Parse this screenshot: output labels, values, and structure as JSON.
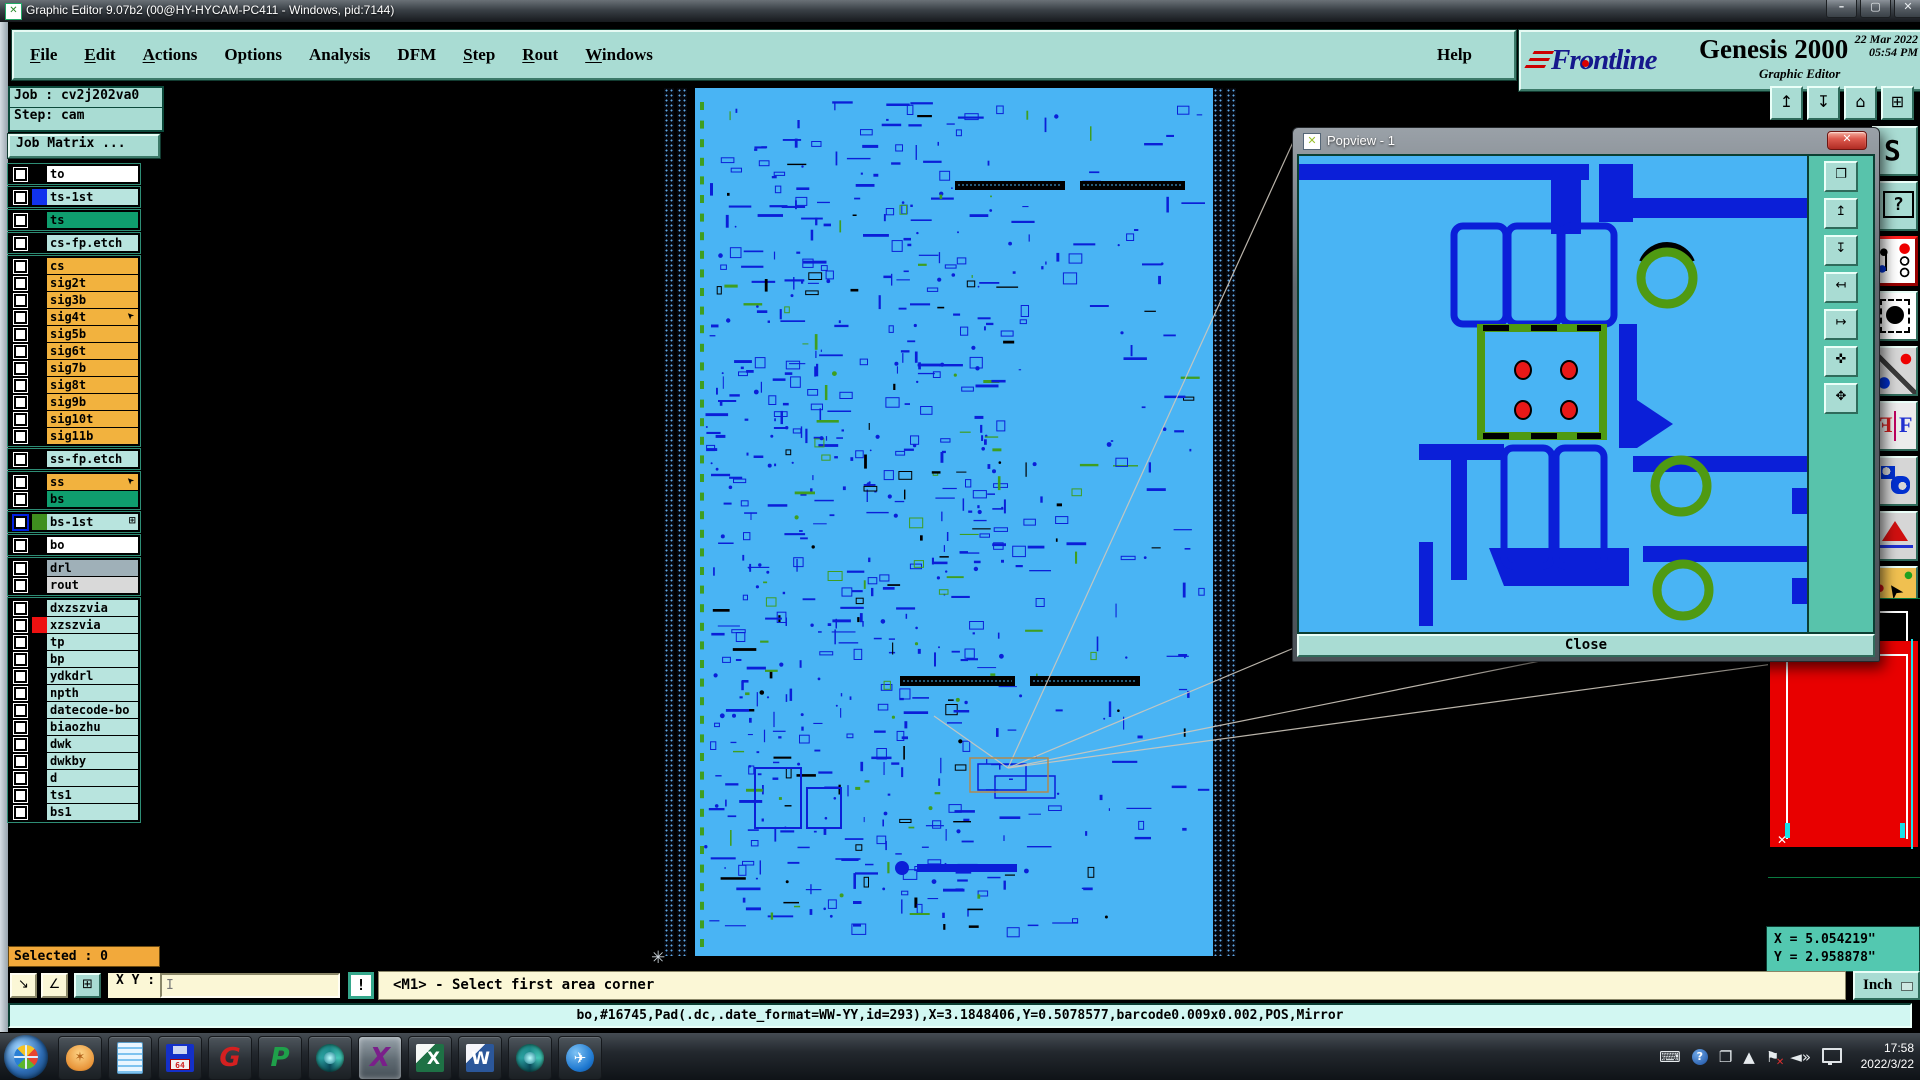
{
  "window": {
    "title": "Graphic Editor 9.07b2 (00@HY-HYCAM-PC411 - Windows, pid:7144)",
    "buttons": {
      "minimize": "–",
      "maximize": "▢",
      "close": "✕"
    }
  },
  "menu": {
    "items": [
      {
        "label": "File",
        "u": 0
      },
      {
        "label": "Edit",
        "u": 0
      },
      {
        "label": "Actions",
        "u": 0
      },
      {
        "label": "Options",
        "u": -1
      },
      {
        "label": "Analysis",
        "u": -1
      },
      {
        "label": "DFM",
        "u": -1
      },
      {
        "label": "Step",
        "u": 0
      },
      {
        "label": "Rout",
        "u": 0
      },
      {
        "label": "Windows",
        "u": 0
      }
    ],
    "help": "Help"
  },
  "brand": {
    "logo_pre": "Fr",
    "logo_o": "o",
    "logo_post": "ntline",
    "product": "Genesis 2000",
    "subtitle": "Graphic Editor",
    "datetime": "22 Mar 2022\n05:54 PM"
  },
  "sidebar": {
    "job_label": "Job : cv2j202va0",
    "step_label": "Step: cam",
    "job_matrix": "Job Matrix ...",
    "selected": "Selected : 0",
    "layer_groups": [
      [
        {
          "name": "to",
          "bg": "#ffffff"
        }
      ],
      [
        {
          "name": "ts-1st",
          "bg": "#b8e4de",
          "swatch": "#1133ee"
        }
      ],
      [
        {
          "name": "ts",
          "bg": "#0f9e6e"
        }
      ],
      [
        {
          "name": "cs-fp.etch",
          "bg": "#b8e4de"
        }
      ],
      [
        {
          "name": "cs",
          "bg": "#f2b23e"
        },
        {
          "name": "sig2t",
          "bg": "#f2b23e"
        },
        {
          "name": "sig3b",
          "bg": "#f2b23e"
        },
        {
          "name": "sig4t",
          "bg": "#f2b23e",
          "cursor": true
        },
        {
          "name": "sig5b",
          "bg": "#f2b23e"
        },
        {
          "name": "sig6t",
          "bg": "#f2b23e"
        },
        {
          "name": "sig7b",
          "bg": "#f2b23e"
        },
        {
          "name": "sig8t",
          "bg": "#f2b23e"
        },
        {
          "name": "sig9b",
          "bg": "#f2b23e"
        },
        {
          "name": "sig10t",
          "bg": "#f2b23e"
        },
        {
          "name": "sig11b",
          "bg": "#f2b23e"
        }
      ],
      [
        {
          "name": "ss-fp.etch",
          "bg": "#b8e4de"
        }
      ],
      [
        {
          "name": "ss",
          "bg": "#f2b23e",
          "cursor": true
        },
        {
          "name": "bs",
          "bg": "#0f9e6e"
        }
      ],
      [
        {
          "name": "bs-1st",
          "bg": "#b8e4de",
          "swatch": "#3f8f1f",
          "cb": "blue",
          "grid": true
        }
      ],
      [
        {
          "name": "bo",
          "bg": "#ffffff"
        }
      ],
      [
        {
          "name": "drl",
          "bg": "#9fb0b8"
        },
        {
          "name": "rout",
          "bg": "#d9d9d9"
        }
      ],
      [
        {
          "name": "dxzszvia",
          "bg": "#b8e4de"
        },
        {
          "name": "xzszvia",
          "bg": "#b8e4de",
          "swatch": "#ee1111"
        },
        {
          "name": "tp",
          "bg": "#b8e4de"
        },
        {
          "name": "bp",
          "bg": "#b8e4de"
        },
        {
          "name": "ydkdrl",
          "bg": "#b8e4de"
        },
        {
          "name": "npth",
          "bg": "#b8e4de"
        },
        {
          "name": "datecode-bo",
          "bg": "#b8e4de"
        },
        {
          "name": "biaozhu",
          "bg": "#b8e4de"
        },
        {
          "name": "dwk",
          "bg": "#b8e4de"
        },
        {
          "name": "dwkby",
          "bg": "#b8e4de"
        },
        {
          "name": "d",
          "bg": "#b8e4de"
        },
        {
          "name": "ts1",
          "bg": "#b8e4de"
        },
        {
          "name": "bs1",
          "bg": "#b8e4de"
        }
      ]
    ]
  },
  "popview": {
    "title": "Popview - 1",
    "close_button": "Close",
    "close_x": "✕",
    "nav_buttons": [
      {
        "name": "detach-view-icon",
        "glyph": "❐"
      },
      {
        "name": "zoom-in-icon",
        "glyph": "↥"
      },
      {
        "name": "zoom-out-icon",
        "glyph": "↧"
      },
      {
        "name": "pan-left-icon",
        "glyph": "↤"
      },
      {
        "name": "pan-right-icon",
        "glyph": "↦"
      },
      {
        "name": "zoom-fit-icon",
        "glyph": "✜"
      },
      {
        "name": "pan-center-icon",
        "glyph": "✥"
      }
    ]
  },
  "right_toolbar": {
    "top": [
      {
        "name": "view-up-icon",
        "glyph": "↥"
      },
      {
        "name": "view-down-icon",
        "glyph": "↧"
      },
      {
        "name": "home-view-icon",
        "glyph": "⌂"
      },
      {
        "name": "tile-views-icon",
        "glyph": "⊞"
      }
    ],
    "side": [
      {
        "name": "step-trace-icon"
      },
      {
        "name": "help-box-icon"
      },
      {
        "name": "netlist-check-icon"
      },
      {
        "name": "pad-select-icon"
      },
      {
        "name": "measure-distance-icon"
      },
      {
        "name": "mirror-compare-icon"
      },
      {
        "name": "surface-tools-icon"
      },
      {
        "name": "measure-profile-icon"
      },
      {
        "name": "select-cursor-icon"
      }
    ]
  },
  "coords": {
    "x": "X = 5.054219\"",
    "y": "Y = 2.958878\""
  },
  "command": {
    "buttons": [
      {
        "name": "snap-mode-icon",
        "glyph": "↘"
      },
      {
        "name": "angle-mode-icon",
        "glyph": "∠"
      },
      {
        "name": "grid-toggle-icon",
        "glyph": "⊞"
      }
    ],
    "xy_label": "X Y :",
    "input_value": "",
    "input_caret": "I",
    "bang": "!",
    "prompt": "<M1> - Select first area corner",
    "units": "Inch"
  },
  "status_line": "bo,#16745,Pad(.dc,.date_format=WW-YY,id=293),X=3.1848406,Y=0.5078577,barcode0.009x0.002,POS,Mirror",
  "taskbar": {
    "apps": [
      {
        "name": "app-shell-viewer",
        "kind": "shell",
        "glyph": "✶"
      },
      {
        "name": "app-notepad",
        "kind": "notes"
      },
      {
        "name": "app-backup-save",
        "kind": "save"
      },
      {
        "name": "app-goldwave",
        "kind": "letter",
        "glyph": "G",
        "color": "#d42020"
      },
      {
        "name": "app-green-p",
        "kind": "letter",
        "glyph": "P",
        "color": "#1fa04a"
      },
      {
        "name": "app-capture-1",
        "kind": "capture"
      },
      {
        "name": "app-exceed-x",
        "kind": "letter",
        "glyph": "X",
        "color": "#7a1f8a",
        "active": true
      },
      {
        "name": "app-excel",
        "kind": "excel",
        "glyph": "X"
      },
      {
        "name": "app-word",
        "kind": "word",
        "glyph": "W"
      },
      {
        "name": "app-capture-2",
        "kind": "capture"
      },
      {
        "name": "app-messenger",
        "kind": "bird",
        "glyph": "✈"
      }
    ],
    "tray": [
      {
        "name": "keyboard-icon",
        "glyph": "⌨"
      },
      {
        "name": "help-tray-icon",
        "glyph": "?",
        "cls": "tray-help"
      },
      {
        "name": "window-tray-icon",
        "glyph": "❐"
      },
      {
        "name": "tray-expand-icon",
        "glyph": "▲"
      },
      {
        "name": "action-center-flag-icon",
        "glyph": "⚑",
        "cls": "tray-flag"
      },
      {
        "name": "volume-icon",
        "glyph": "◄»"
      },
      {
        "name": "network-icon",
        "glyph": "",
        "cls": "tray-net"
      }
    ],
    "time": "17:58",
    "date": "2022/3/22"
  },
  "colors": {
    "panel_teal": "#a9dcd3",
    "sidebar_teal": "#58c3ab",
    "layer_orange": "#f2b23e",
    "layer_cyan": "#b8e4de",
    "layer_green": "#0f9e6e",
    "board_blue": "#49b4f4",
    "trace_blue": "#0b1fd8",
    "popview_green": "#4f9a12",
    "alert_red": "#e80000",
    "cream": "#fbf7d6",
    "status_cyan": "#d2f7f2"
  }
}
